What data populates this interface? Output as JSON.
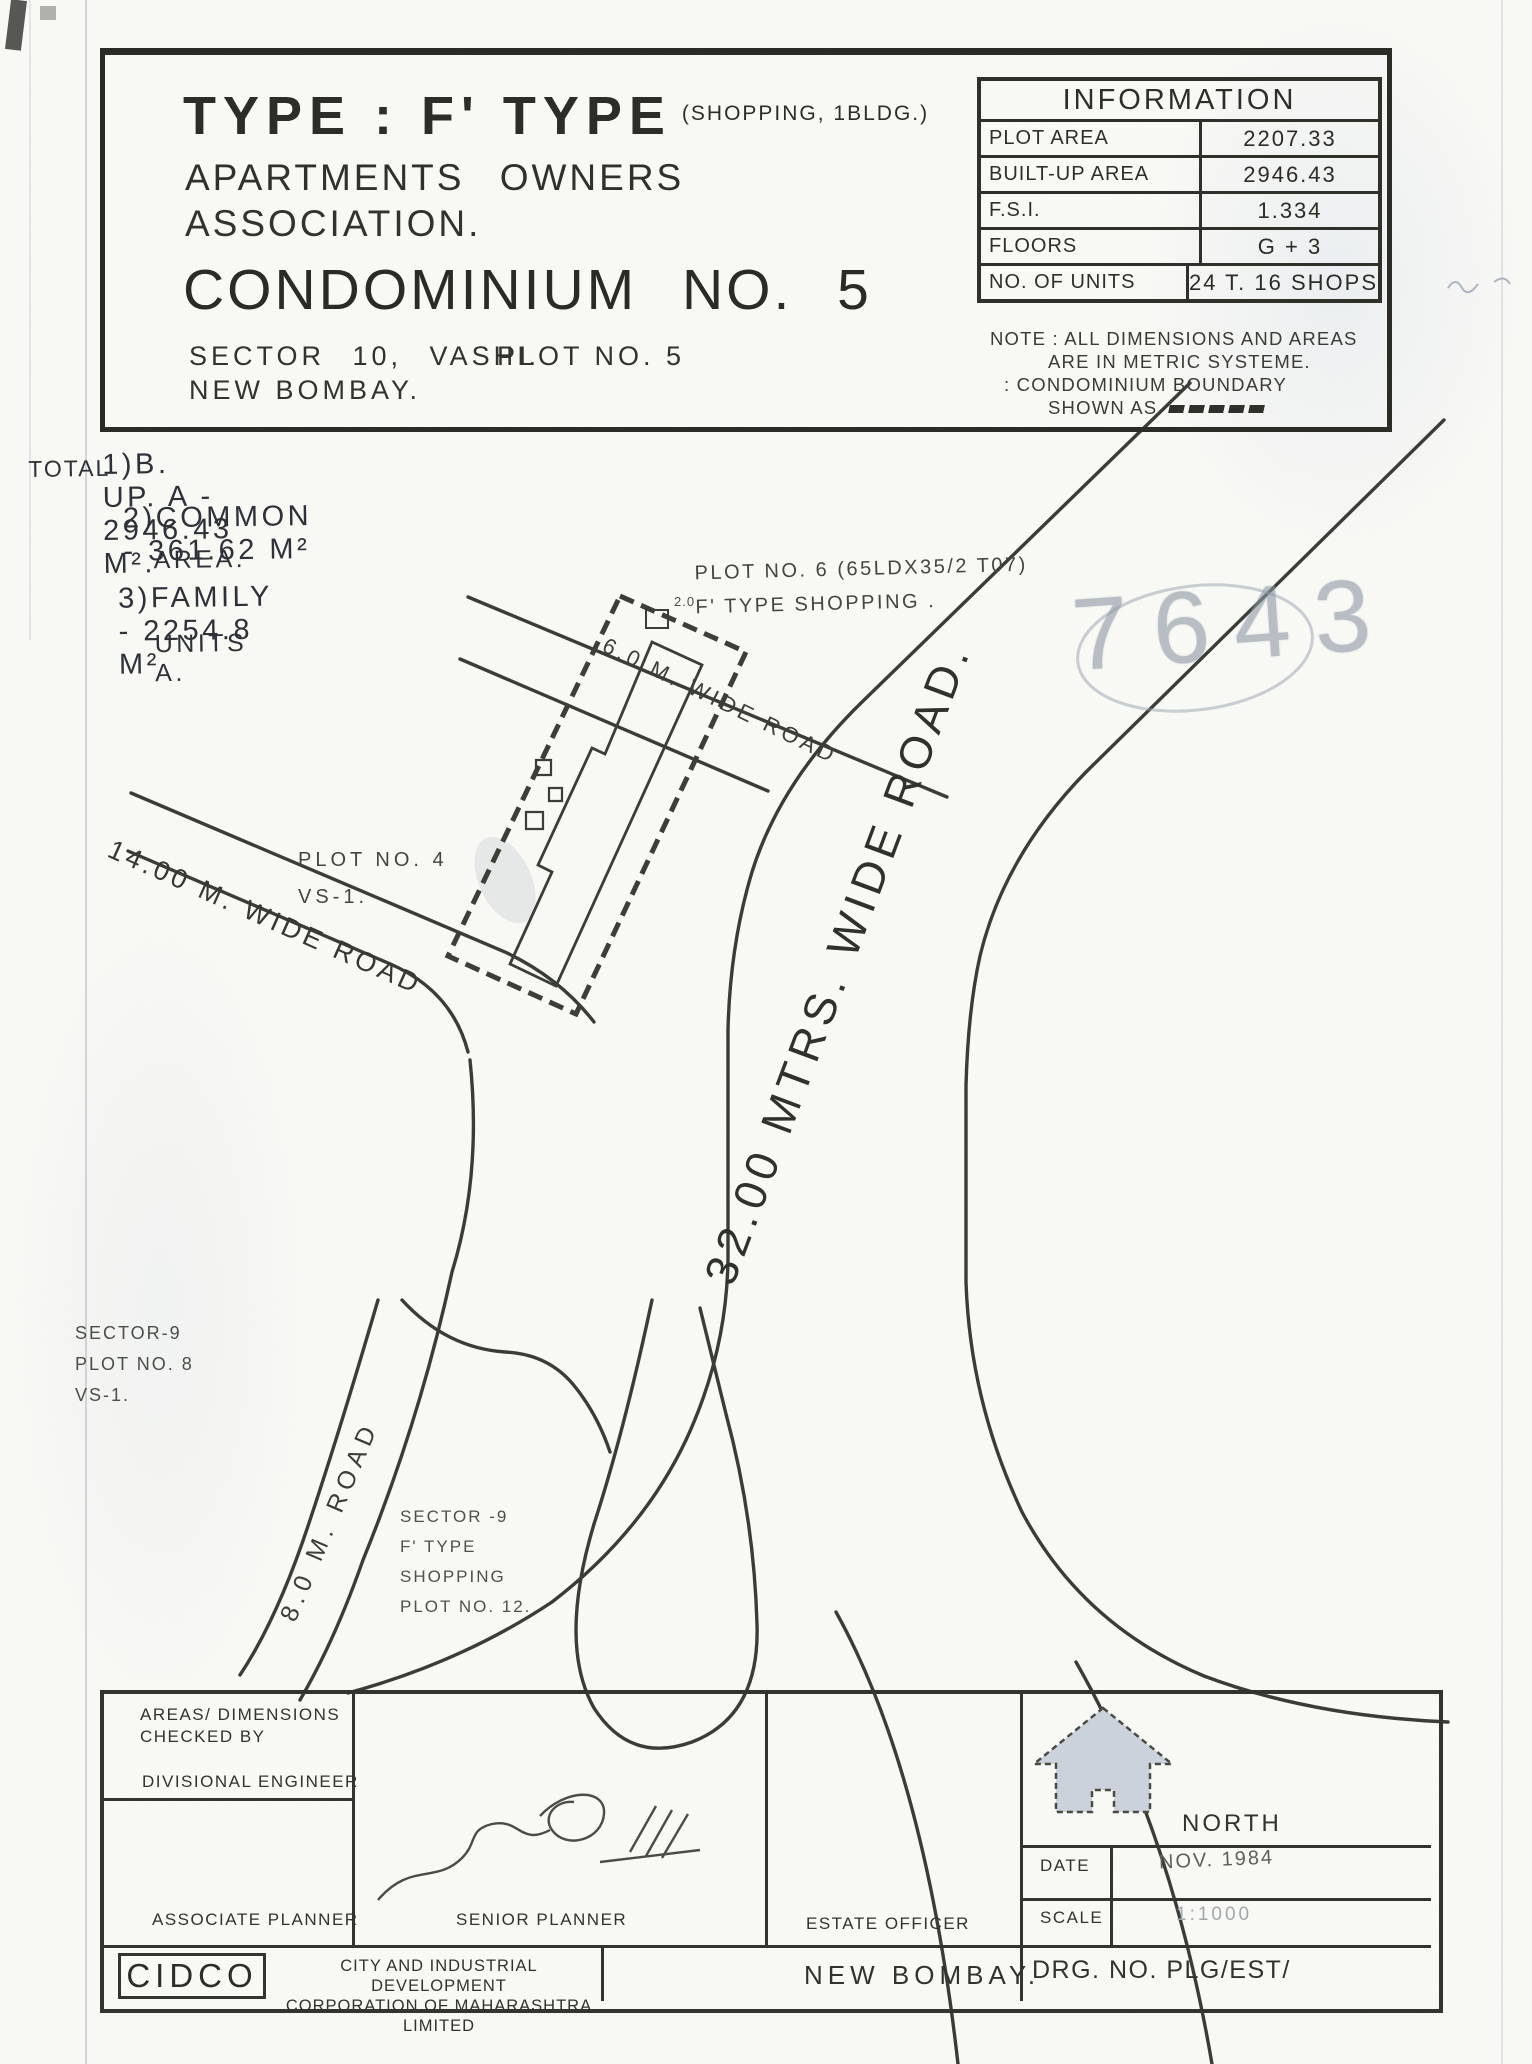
{
  "colors": {
    "ink": "#32322c",
    "paper": "#fafaf6",
    "pencil_annotation": "#8d97a3",
    "north_arrow_fill": "#ccd2db"
  },
  "title_block": {
    "type_prefix": "TYPE : ",
    "type_value": "F' TYPE",
    "type_note": "(SHOPPING, 1BLDG.)",
    "org_line1": "APARTMENTS OWNERS",
    "org_line2": "ASSOCIATION.",
    "name": "CONDOMINIUM NO. 5",
    "sector": "SECTOR 10, VASHI.",
    "plot": "PLOT NO. 5",
    "city": "NEW BOMBAY."
  },
  "information": {
    "title": "INFORMATION",
    "rows": [
      {
        "label": "PLOT AREA",
        "value": "2207.33"
      },
      {
        "label": "BUILT-UP AREA",
        "value": "2946.43"
      },
      {
        "label": "F.S.I.",
        "value": "1.334"
      },
      {
        "label": "FLOORS",
        "value": "G + 3"
      },
      {
        "label": "NO. OF UNITS",
        "value": "24 T. 16 SHOPS"
      }
    ],
    "note_line1": "NOTE : ALL DIMENSIONS AND AREAS",
    "note_line2": "ARE IN METRIC SYSTEME.",
    "note_line3": ": CONDOMINIUM BOUNDARY",
    "note_line4": "SHOWN AS."
  },
  "totals": {
    "heading": "TOTAL",
    "line1": "1)B. UP. A - 2946.43 M².",
    "line2": "2)COMMON -  361.62 M²",
    "line3": "AREA.",
    "line4": "3)FAMILY - 2254.8 M²",
    "line5": "UNITS A."
  },
  "plan": {
    "plot6_line1": "PLOT NO. 6 (65LDX35/2 T07)",
    "plot6_line2": "F' TYPE SHOPPING .",
    "road_6m": "6.0 M. WIDE ROAD",
    "road_32m": "32.00 MTRS. WIDE ROAD.",
    "road_14m": "14.00 M. WIDE ROAD",
    "road_8m": "8.0 M. ROAD",
    "plot4_line1": "PLOT NO. 4",
    "plot4_line2": "VS-1.",
    "sector9a_line1": "SECTOR-9",
    "sector9a_line2": "PLOT NO. 8",
    "sector9a_line3": "VS-1.",
    "sector9b_line1": "SECTOR -9",
    "sector9b_line2": "F' TYPE",
    "sector9b_line3": "SHOPPING",
    "sector9b_line4": "PLOT NO. 12.",
    "dim_mark": "2.0",
    "pencil_number": "7643"
  },
  "footer": {
    "checked_line1": "AREAS/ DIMENSIONS",
    "checked_line2": "CHECKED BY",
    "divisional_engineer": "DIVISIONAL ENGINEER",
    "associate_planner": "ASSOCIATE PLANNER",
    "senior_planner": "SENIOR PLANNER",
    "estate_officer": "ESTATE OFFICER",
    "north": "NORTH",
    "date_label": "DATE",
    "date_value": "NOV. 1984",
    "scale_label": "SCALE",
    "scale_value": "1:1000",
    "org_abbr": "CIDCO",
    "org_line1": "CITY AND INDUSTRIAL DEVELOPMENT",
    "org_line2": "CORPORATION OF MAHARASHTRA LIMITED",
    "city": "NEW BOMBAY.",
    "drg": "DRG. NO. PLG/EST/"
  }
}
